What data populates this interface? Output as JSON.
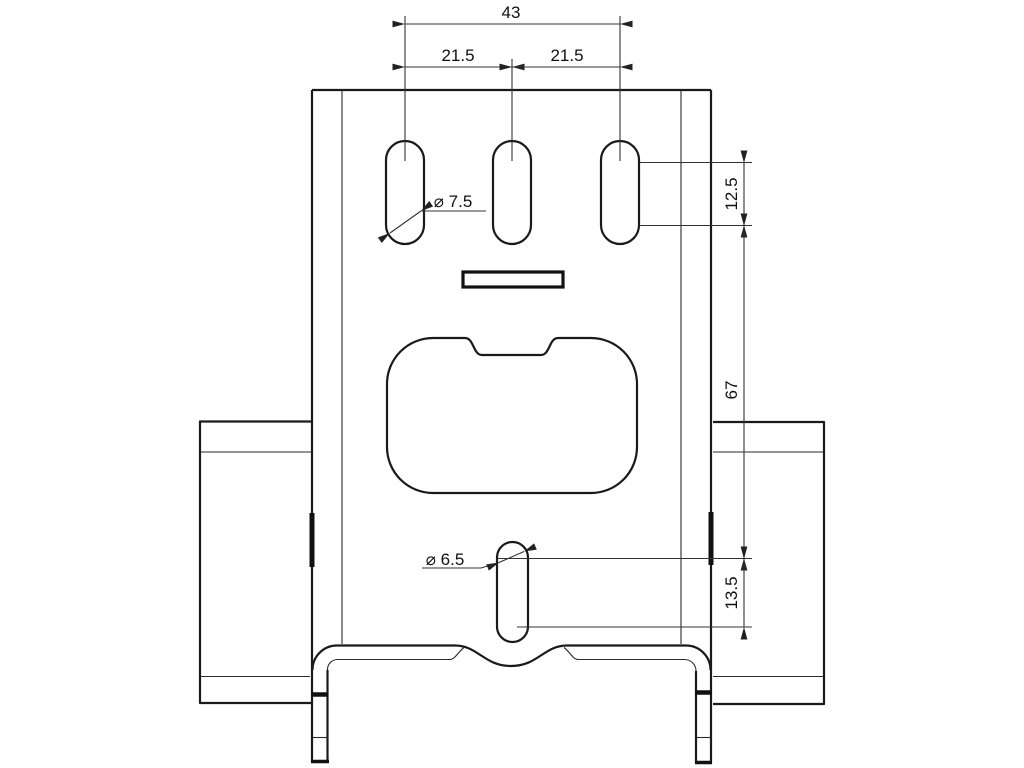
{
  "drawing": {
    "background": "#ffffff",
    "line_color": "#1a1a1a",
    "dim_color": "#333333",
    "dims": {
      "top_total": "43",
      "top_left_pitch": "21.5",
      "top_right_pitch": "21.5",
      "upper_slot_length": "12.5",
      "slot_span": "67",
      "lower_slot_length": "13.5",
      "upper_slot_width": "⌀ 7.5",
      "lower_slot_width": "⌀ 6.5"
    }
  }
}
